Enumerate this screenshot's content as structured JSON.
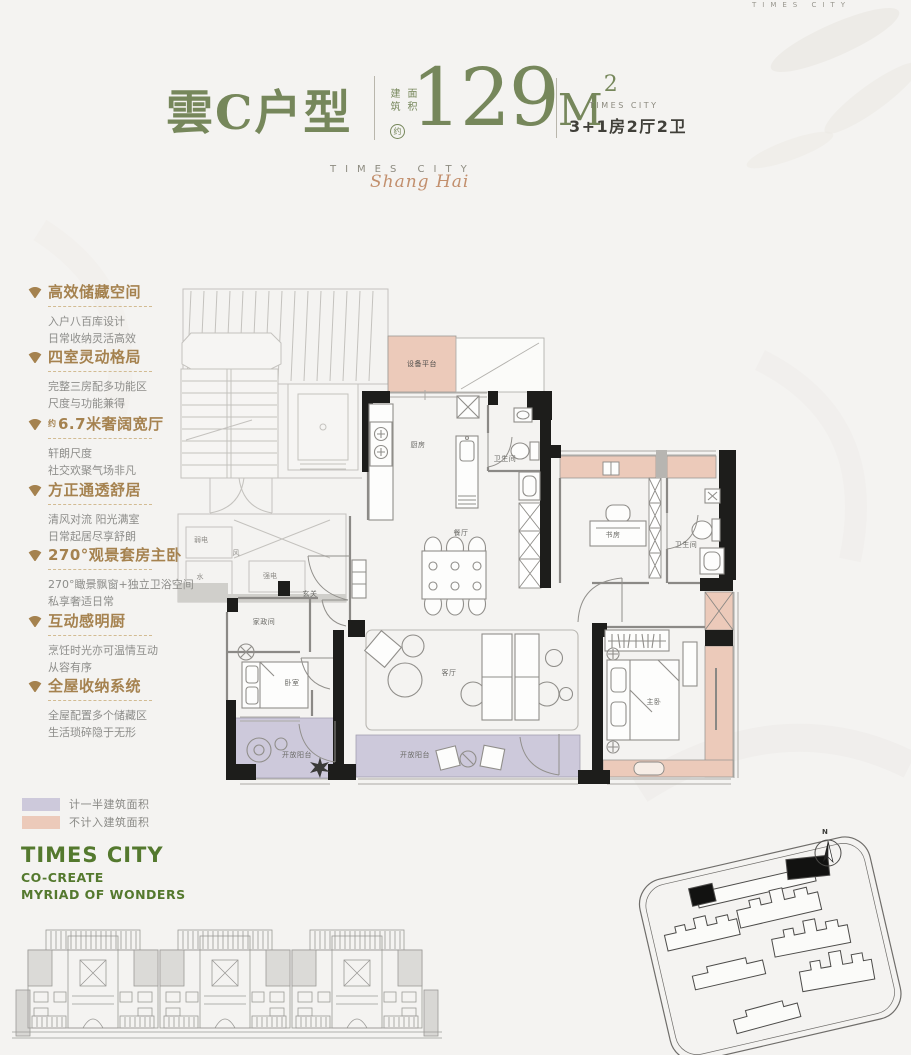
{
  "colors": {
    "background": "#f4f3f1",
    "accent_green": "#76875b",
    "brand_green": "#54792e",
    "accent_brown": "#a5824f",
    "body_gray": "#8d8d8a",
    "wall_black": "#1d1d1b",
    "legend_purple": "#cdc9db",
    "legend_pink": "#eccaba",
    "script_tan": "#c28f6d"
  },
  "header": {
    "corner_watermark": "TIMES CITY",
    "title": "雲C户型",
    "area_label_col1": "建筑",
    "area_label_col2": "面积",
    "area_approx_badge": "约",
    "area_value": "129",
    "area_unit": "M",
    "area_exponent": "2",
    "brand_caption": "TIMES CITY",
    "unit_spec": "3+1房2厅2卫",
    "brand_spaced": "TIMES CITY",
    "brand_script": "Shang Hai"
  },
  "features": [
    {
      "title": "高效储藏空间",
      "lines": [
        "入户八百库设计",
        "日常收纳灵活高效"
      ]
    },
    {
      "title": "四室灵动格局",
      "lines": [
        "完整三房配多功能区",
        "尺度与功能兼得"
      ]
    },
    {
      "prefix": "约",
      "title": "6.7米奢阔宽厅",
      "lines": [
        "轩朗尺度",
        "社交欢聚气场非凡"
      ]
    },
    {
      "title": "方正通透舒居",
      "lines": [
        "清风对流 阳光满室",
        "日常起居尽享舒朗"
      ]
    },
    {
      "title": "270°观景套房主卧",
      "lines": [
        "270°瞰景飘窗+独立卫浴空间",
        "私享奢适日常"
      ]
    },
    {
      "title": "互动感明厨",
      "lines": [
        "烹饪时光亦可温情互动",
        "从容有序"
      ]
    },
    {
      "title": "全屋收纳系统",
      "lines": [
        "全屋配置多个储藏区",
        "生活琐碎隐于无形"
      ]
    }
  ],
  "plan": {
    "rooms": [
      "设备平台",
      "厨房",
      "卫生间",
      "餐厅",
      "书房",
      "卫生间",
      "玄关",
      "家政间",
      "卧室",
      "客厅",
      "开放阳台",
      "开放阳台",
      "主卧"
    ],
    "shafts": [
      "弱电",
      "风",
      "水",
      "强电"
    ]
  },
  "legend": {
    "items": [
      {
        "label": "计一半建筑面积",
        "color": "#cdc9db"
      },
      {
        "label": "不计入建筑面积",
        "color": "#eccaba"
      }
    ]
  },
  "footer": {
    "brand": "TIMES CITY",
    "tagline1": "CO-CREATE",
    "tagline2": "MYRIAD OF WONDERS"
  },
  "site": {
    "north_label": "N"
  }
}
